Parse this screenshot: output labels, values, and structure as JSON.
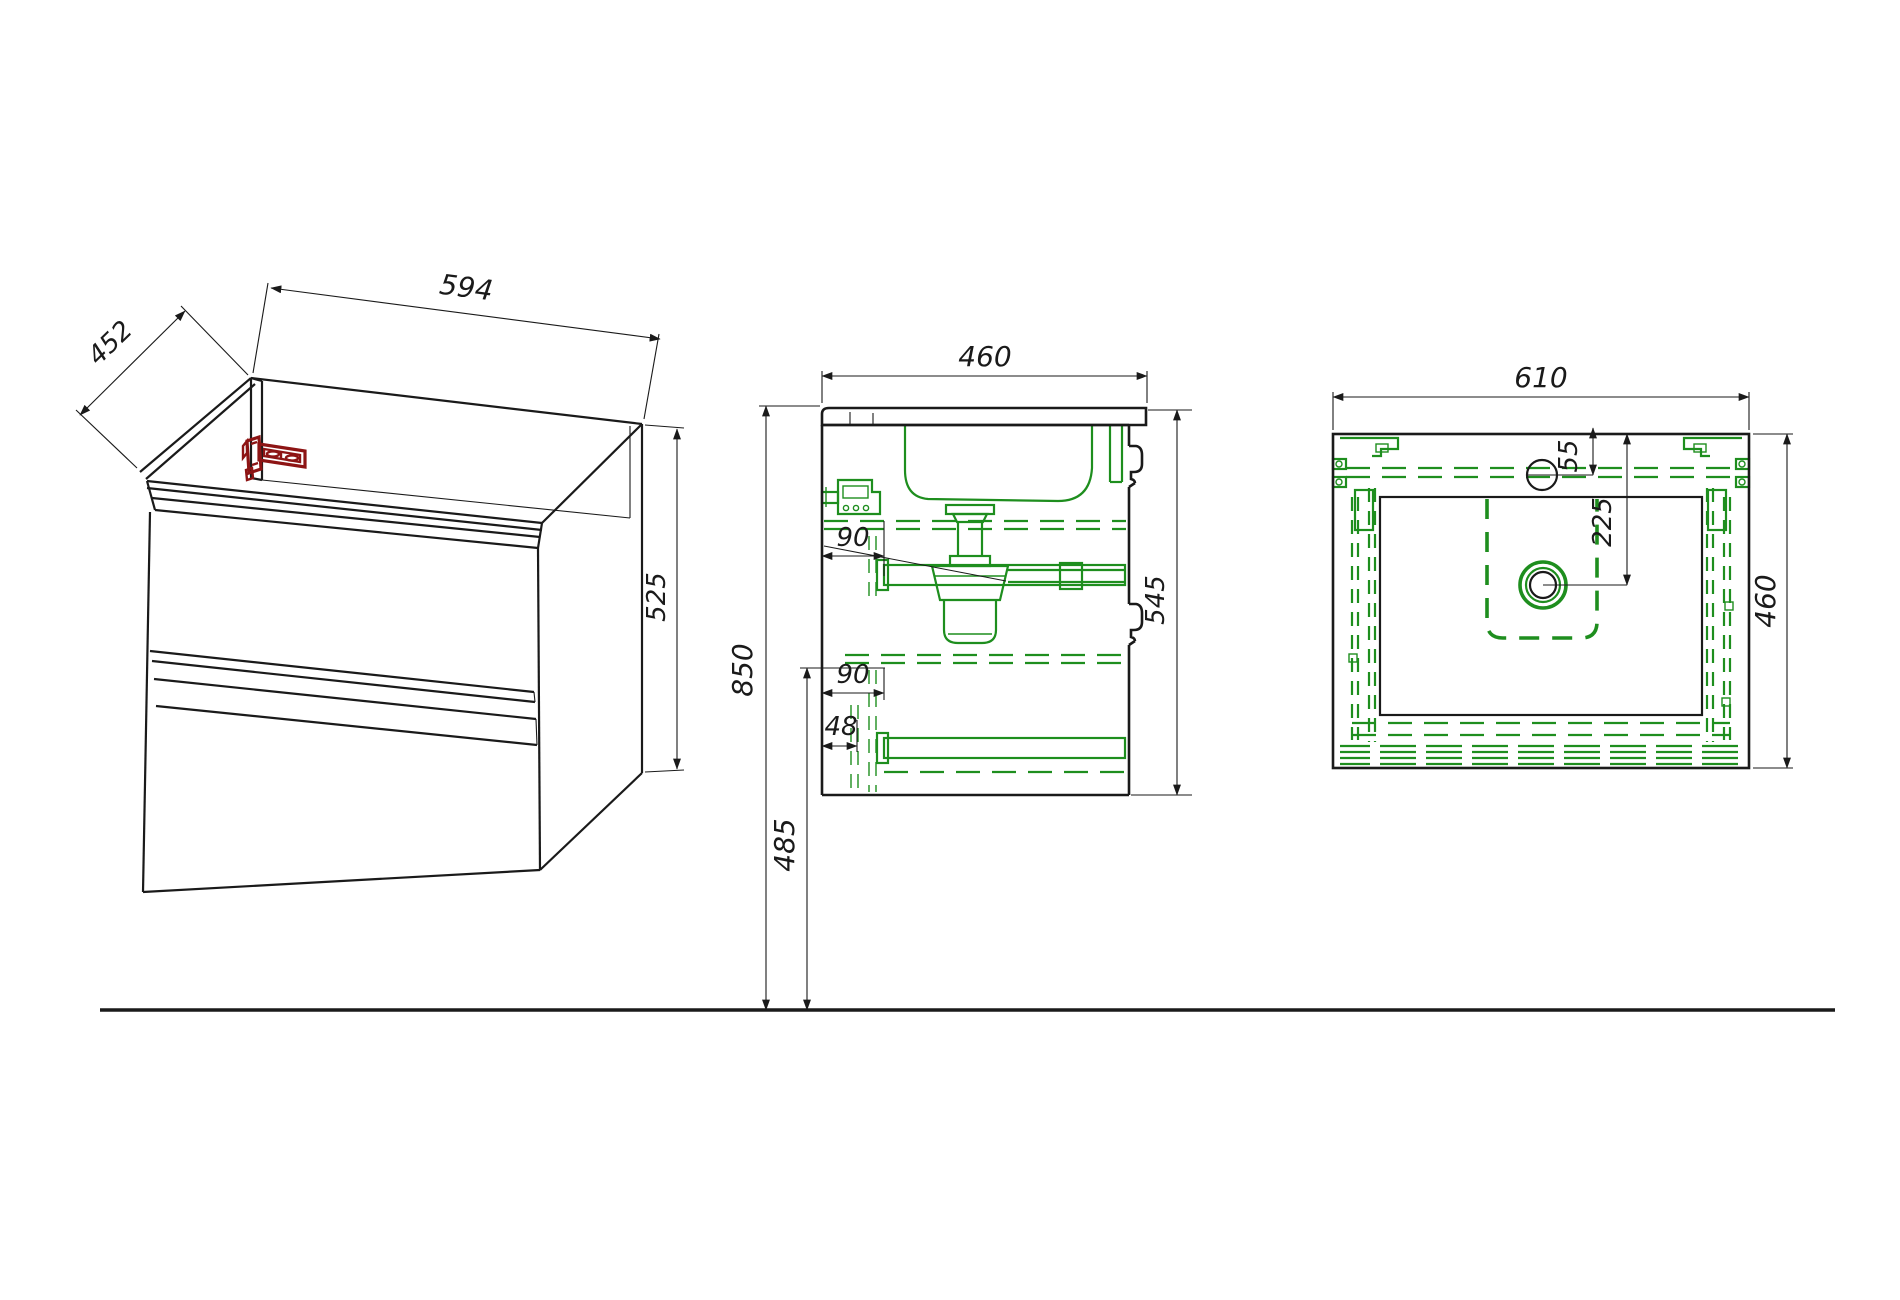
{
  "colors": {
    "outline": "#1a1a1a",
    "hidden_green": "#1e8e1e",
    "bracket_red": "#8d1414",
    "background": "#ffffff"
  },
  "dims": {
    "iso_depth": "452",
    "iso_width": "594",
    "iso_height": "525",
    "side_depth": "460",
    "side_height": "545",
    "side_slide_top": "90",
    "side_slide_bottom": "90",
    "side_front": "48",
    "side_floor_top": "850",
    "side_floor_bottom": "485",
    "top_width": "610",
    "top_faucet": "55",
    "top_drain": "225",
    "top_depth": "460"
  }
}
